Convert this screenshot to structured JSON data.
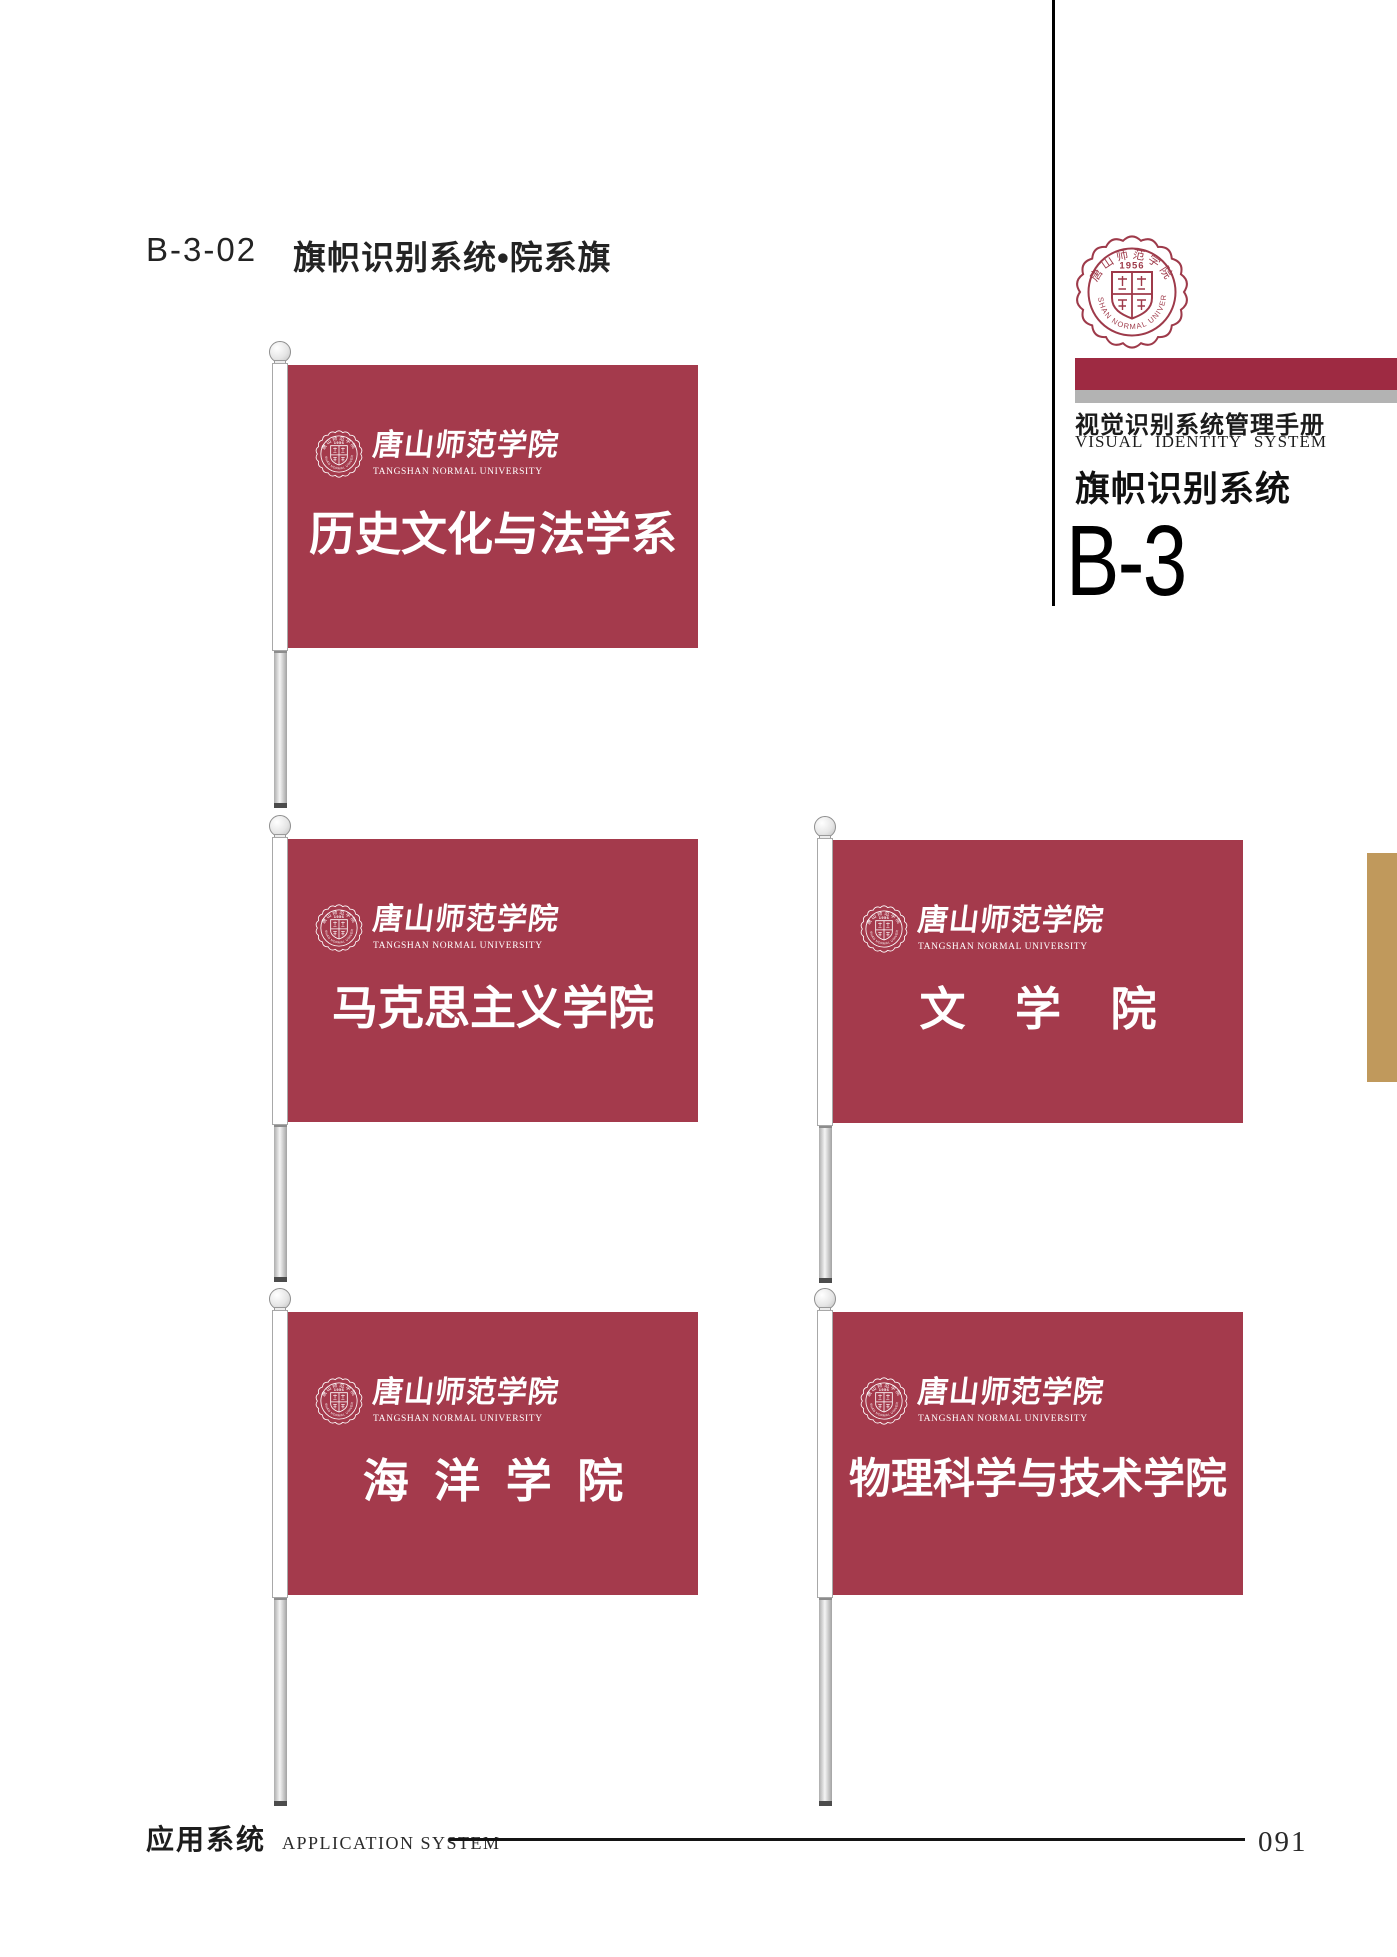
{
  "page": {
    "code": "B-3-02",
    "title": "旗帜识别系统•院系旗",
    "page_number": "091",
    "footer_cn": "应用系统",
    "footer_en": "APPLICATION SYSTEM"
  },
  "sidebar": {
    "manual_title_cn": "视觉识别系统管理手册",
    "manual_title_en": "VISUAL IDENTITY SYSTEM",
    "section_title_cn": "旗帜识别系统",
    "section_code": "B-3"
  },
  "university": {
    "name_cn": "唐山师范学院",
    "name_en": "TANGSHAN NORMAL UNIVERSITY",
    "founded_year": "1956"
  },
  "flags": [
    {
      "department": "历史文化与法学系"
    },
    {
      "department": "马克思主义学院"
    },
    {
      "department": "文 学 院"
    },
    {
      "department": "海 洋 学 院"
    },
    {
      "department": "物理科学与技术学院"
    }
  ],
  "colors": {
    "flag_red": "#A43A4C",
    "bar_red": "#9E2A42",
    "bar_gray": "#B3B3B3",
    "accent_tan": "#C0995C",
    "seal_red": "#9E3A4A"
  }
}
